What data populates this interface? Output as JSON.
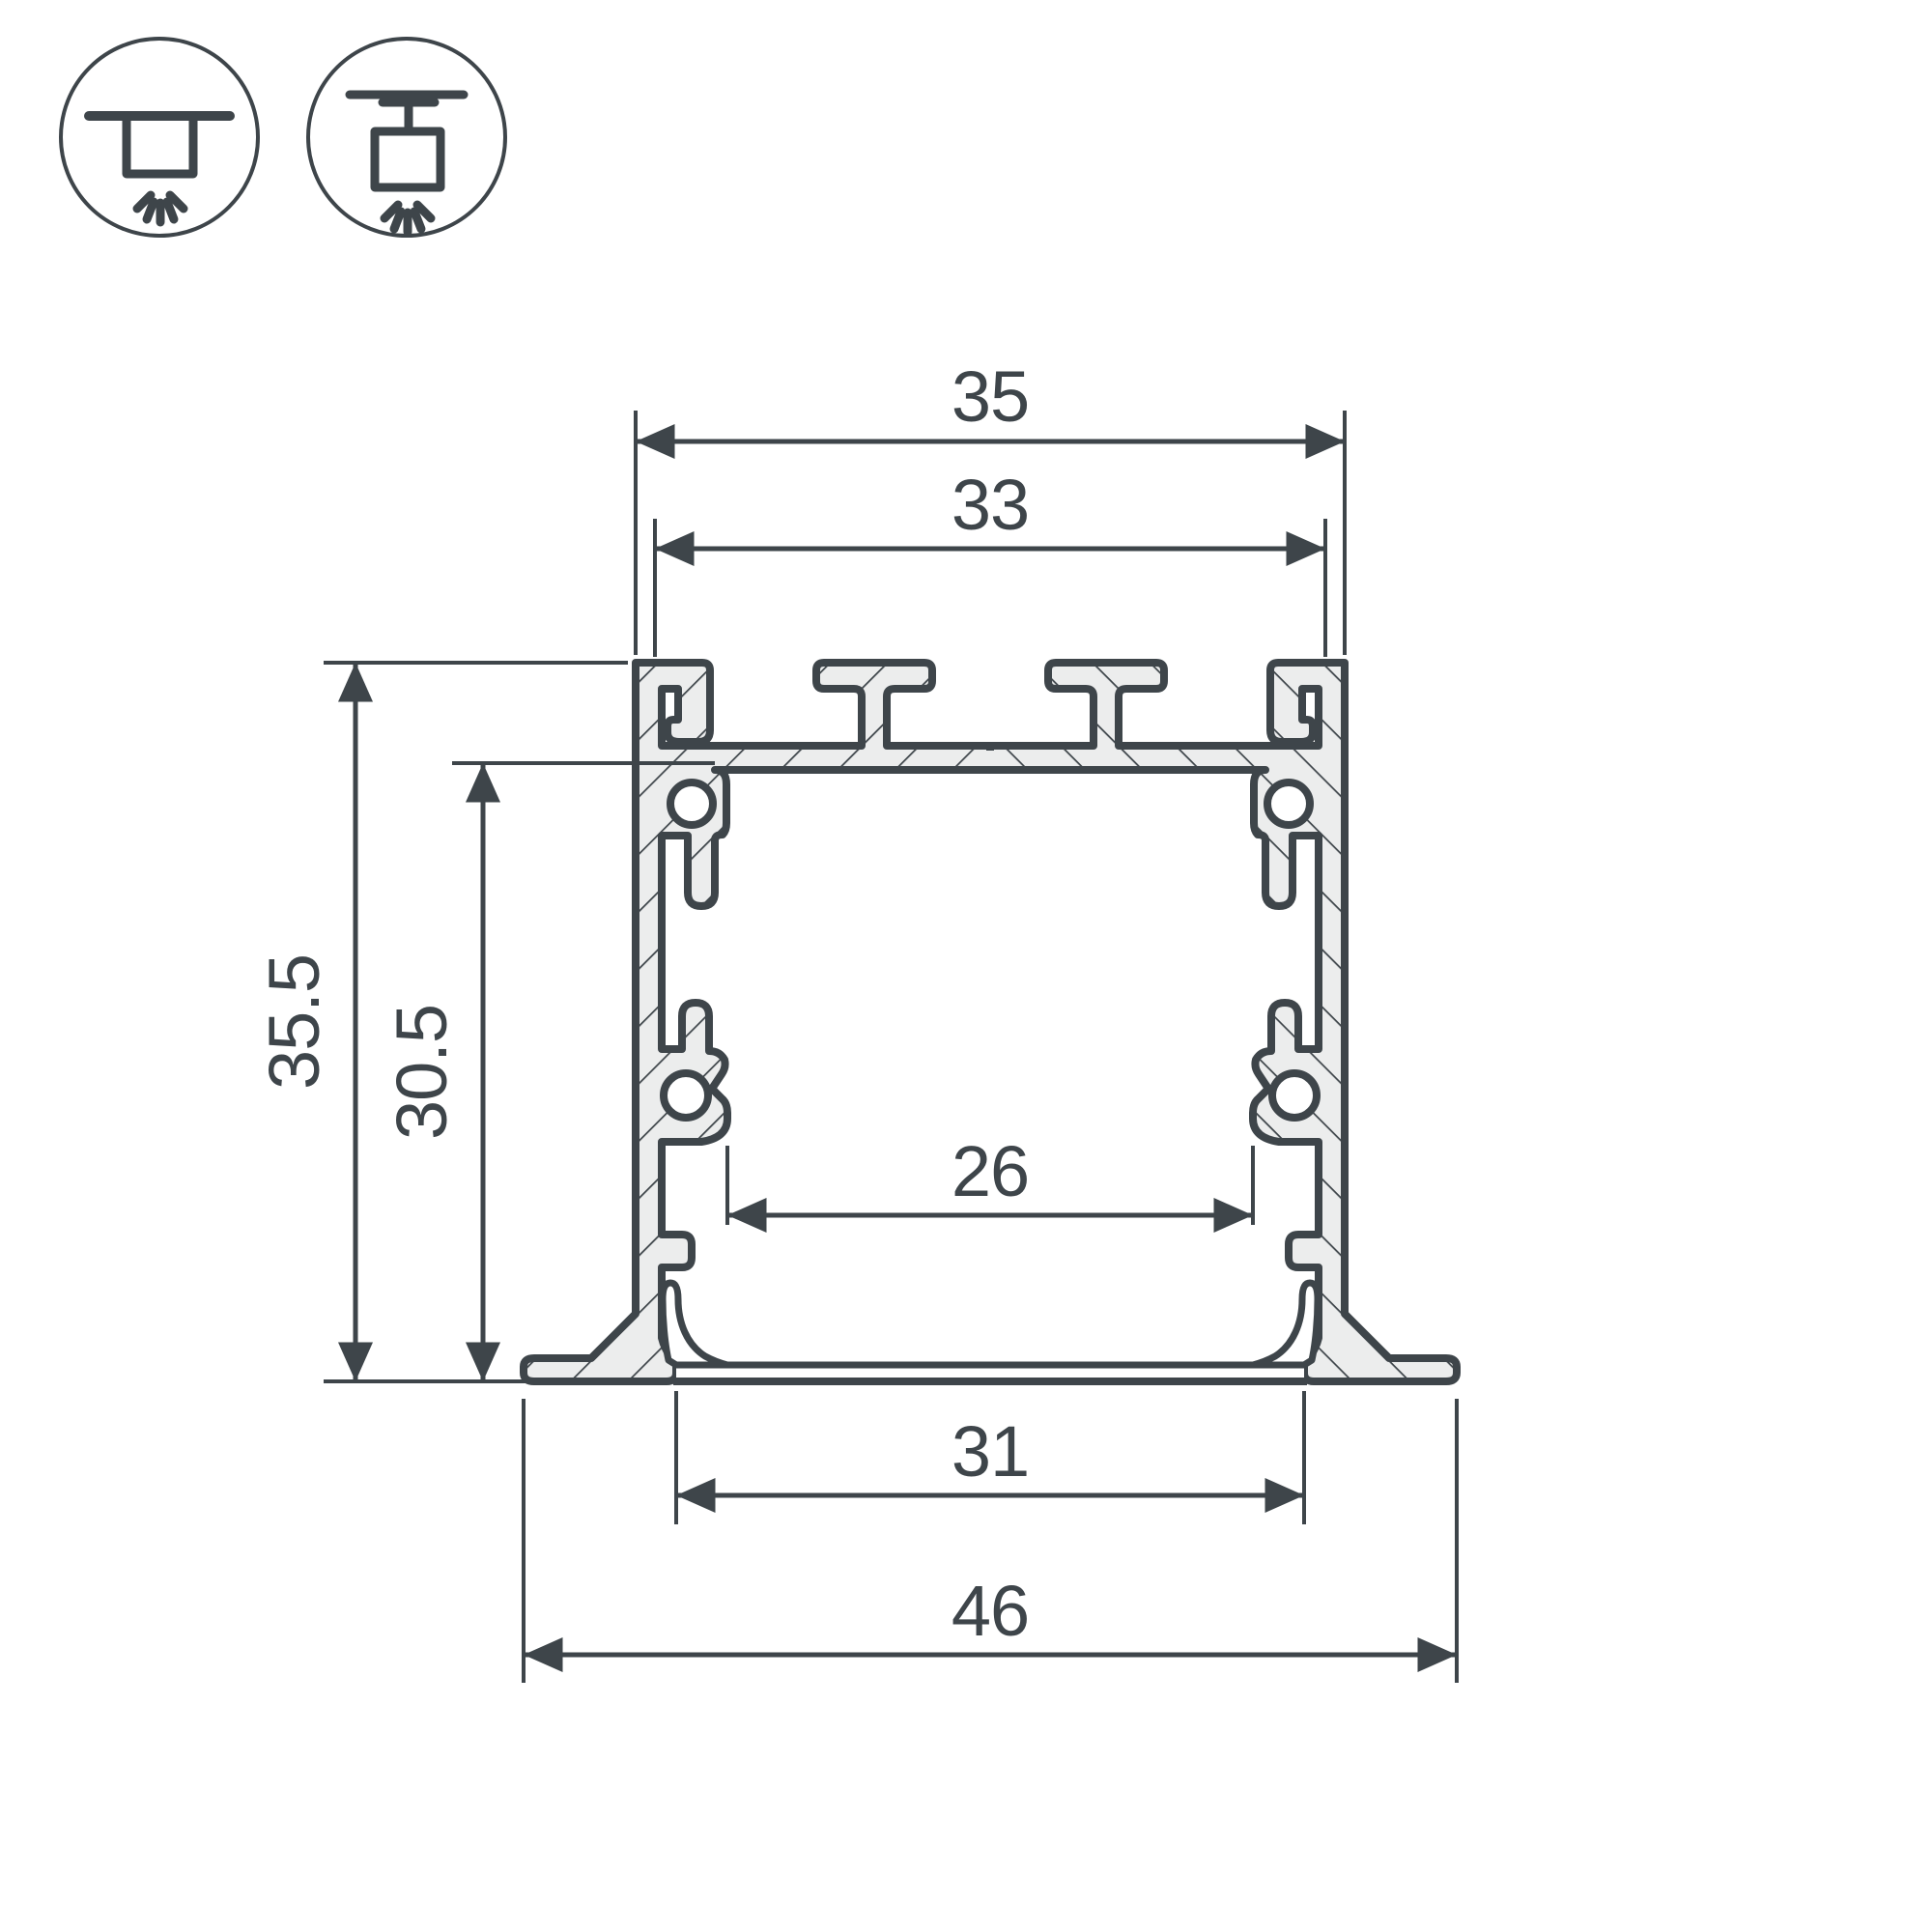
{
  "drawing": {
    "title": "led-profile-cross-section",
    "dimensions": {
      "outer_width": "35",
      "top_inner_width": "33",
      "outer_height": "35.5",
      "inner_height": "30.5",
      "cavity_width": "26",
      "bottom_inner_width": "31",
      "flange_width": "46"
    },
    "icons": [
      {
        "name": "recessed-mount-icon"
      },
      {
        "name": "suspended-mount-icon"
      }
    ],
    "colors": {
      "line": "#3E454A",
      "hatch_fill": "#ECEDED",
      "background": "#FFFFFF"
    }
  }
}
